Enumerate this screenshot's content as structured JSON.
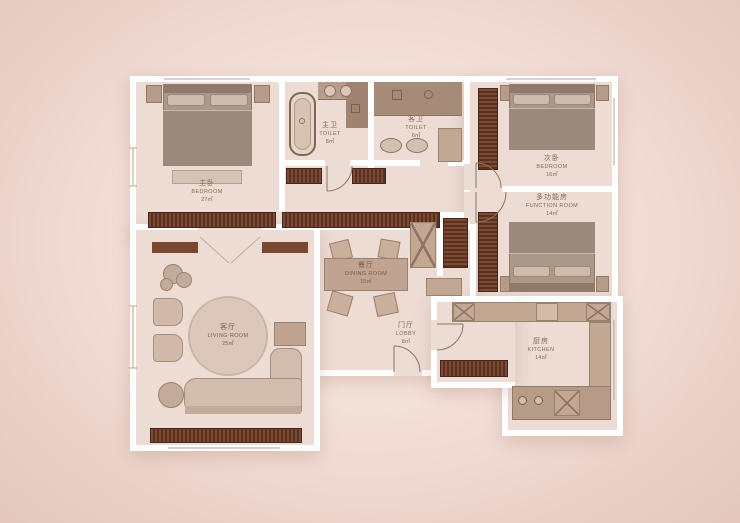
{
  "canvas": {
    "width": 740,
    "height": 523
  },
  "palette": {
    "background_center": "#f9ece5",
    "background_edge": "#e3c7bd",
    "floor": "#ecdcd4",
    "wall": "#ffffff",
    "dark_wood_cabinet": "#6a3b28",
    "light_cabinet": "#c2a892",
    "upholstery": "#d2bcad",
    "label_text": "#8a6753"
  },
  "rooms": [
    {
      "id": "master-bedroom",
      "zh": "主卧",
      "en": "BEDROOM",
      "area": "27㎡"
    },
    {
      "id": "master-toilet",
      "zh": "主卫",
      "en": "TOILET",
      "area": "8㎡"
    },
    {
      "id": "guest-toilet",
      "zh": "客卫",
      "en": "TOILET",
      "area": "6㎡"
    },
    {
      "id": "second-bedroom",
      "zh": "次卧",
      "en": "BEDROOM",
      "area": "16㎡"
    },
    {
      "id": "function-room",
      "zh": "多功能房",
      "en": "FUNCTION ROOM",
      "area": "14㎡"
    },
    {
      "id": "kitchen",
      "zh": "厨房",
      "en": "KITCHEN",
      "area": "14㎡"
    },
    {
      "id": "dining-room",
      "zh": "餐厅",
      "en": "DINING ROOM",
      "area": "15㎡"
    },
    {
      "id": "lobby",
      "zh": "门厅",
      "en": "LOBBY",
      "area": "8㎡"
    },
    {
      "id": "living-room",
      "zh": "客厅",
      "en": "LIVING ROOM",
      "area": "25㎡"
    }
  ]
}
